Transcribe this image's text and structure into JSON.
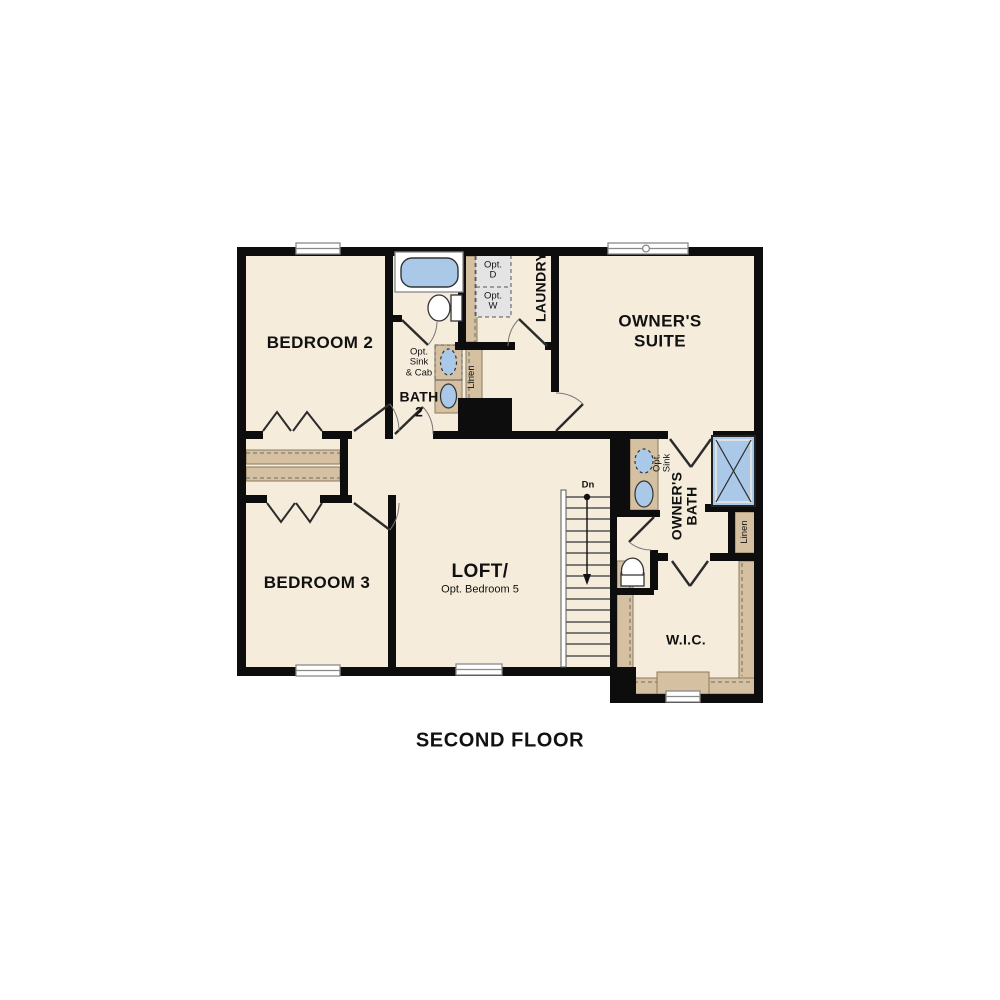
{
  "plan": {
    "title": "SECOND FLOOR",
    "rooms": {
      "bedroom2": "BEDROOM 2",
      "bedroom3": "BEDROOM 3",
      "owners_suite": "OWNER'S\nSUITE",
      "loft": "LOFT/",
      "loft_option": "Opt. Bedroom 5",
      "bath2": "BATH\n2",
      "laundry": "LAUNDRY",
      "owners_bath": "OWNER'S\nBATH",
      "wic": "W.I.C."
    },
    "annotations": {
      "opt_sink_cab": "Opt.\nSink\n& Cab",
      "opt_dryer": "Opt.\nD",
      "opt_washer": "Opt.\nW",
      "opt_sink": "Opt.\nSink",
      "linen_bath2": "Linen",
      "linen_owners": "Linen",
      "stairs_down": "Dn"
    },
    "colors": {
      "floor": "#f5ecdc",
      "wall": "#0d0d0d",
      "shelving_tan": "#d5c1a1",
      "fixture_blue": "#aac9e8",
      "appliance_gray": "#e4e4e4"
    }
  }
}
